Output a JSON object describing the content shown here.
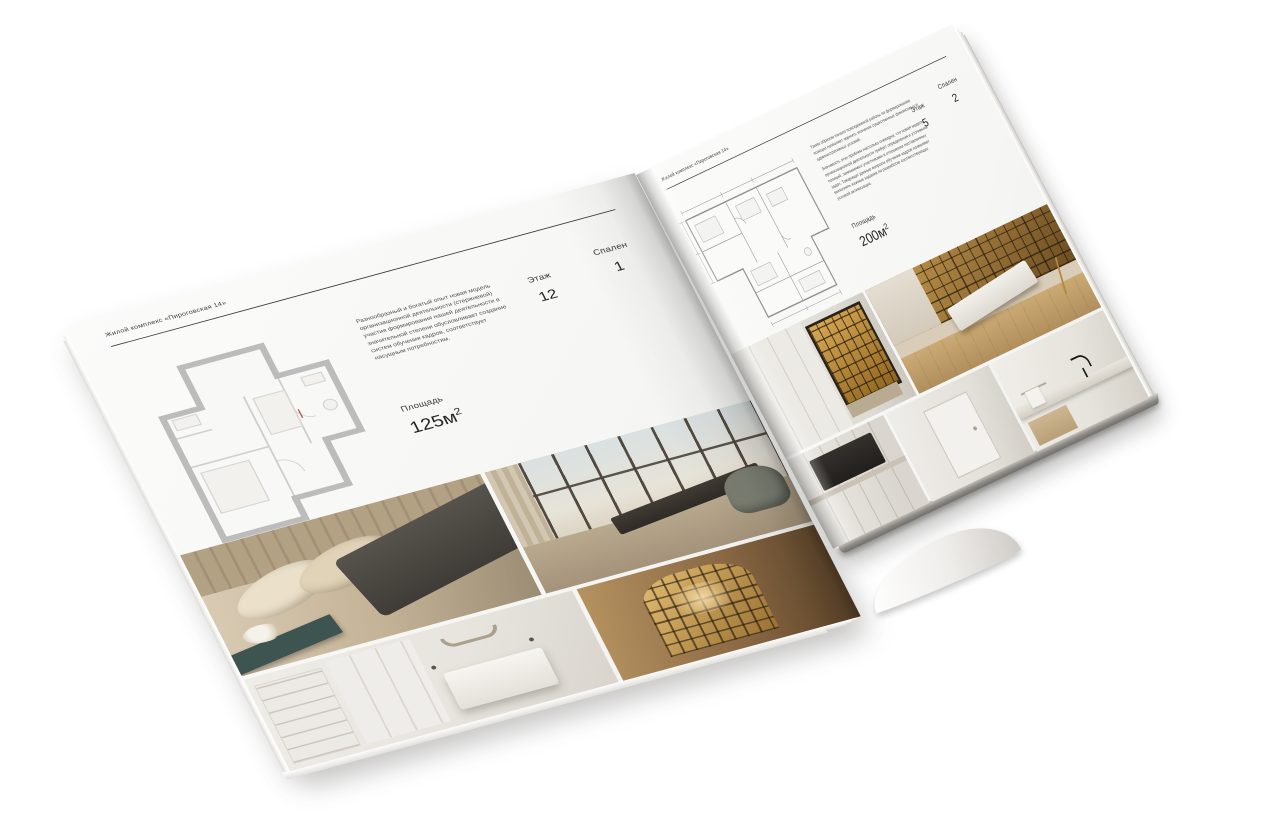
{
  "brochure": {
    "left_page": {
      "header": "Жилой комплекс «Пироговская 14»",
      "description": "Разнообразный и богатый опыт новая модель организационной деятельности (стержневой) участия формирования нашей деятельности в значительной степени обусловливает создание систем обучения кадров, соответствует насущным потребностям.",
      "area_label": "Площадь",
      "area_value": "125м",
      "area_sup": "2",
      "floor_label": "Этаж",
      "floor_value": "12",
      "bedrooms_label": "Спален",
      "bedrooms_value": "1",
      "photos": [
        "beige-bedroom",
        "living-room-window-wall",
        "white-bedroom",
        "wood-hallway-niche"
      ]
    },
    "right_page": {
      "header": "Жилой комплекс «Пироговская 14»",
      "description_1": "Таким образом начало повседневной работы по формированию позиции позволяет оценить значение существенных финансовых и административных условий.",
      "description_2": "Значимость этих проблем настолько очевидна, что новая модель организационной деятельности требует определения и уточнения позиций, занимаемых участниками в отношении поставленных задач. Товарищи! данные вопросы обучения кадров позволяют выполнять важные задания по разработке соответствующих условий активизации.",
      "area_label": "Площадь",
      "area_value": "200м",
      "area_sup": "2",
      "floor_label": "Этаж",
      "floor_value": "5",
      "bedrooms_label": "Спален",
      "bedrooms_value": "2",
      "photos": [
        "display-cabinet",
        "study-bookshelf-wall",
        "kitchen-cooktop",
        "white-corridor",
        "bathroom-vanity"
      ]
    },
    "colors": {
      "paper": "#f9f9f8",
      "rule": "#333330",
      "text": "#3b3b3b",
      "plan_left_walls": "#bcbcbc",
      "plan_right_lines": "#8f8f8f",
      "amber_shelves": "#c79b50",
      "warm_wood": "#8a6844"
    }
  }
}
